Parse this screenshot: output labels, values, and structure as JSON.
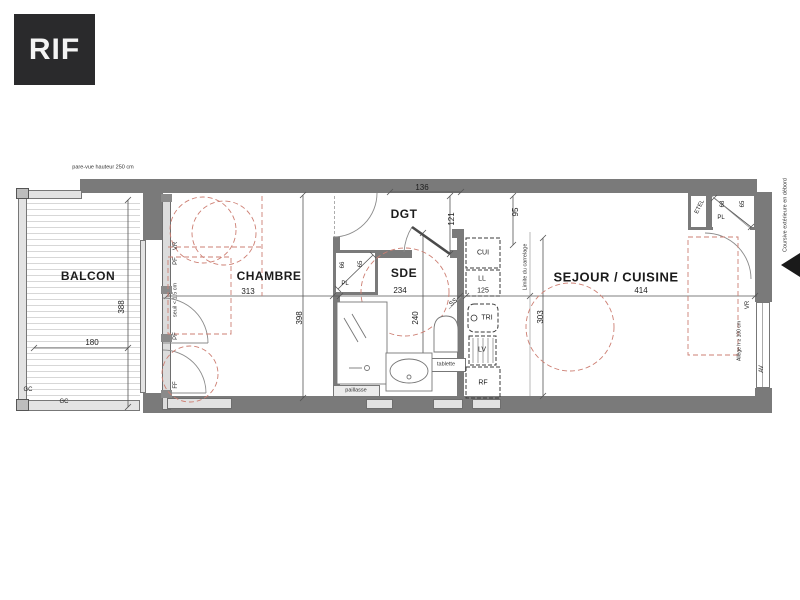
{
  "logo": {
    "text": "RIF"
  },
  "colors": {
    "wall": "#7a7a7a",
    "furniture_dashed": "#cd7f73",
    "logo_bg": "#2a2a2c"
  },
  "annotations": {
    "pare_vue": "pare-vue hauteur 250 cm",
    "coursive": "Coursive extérieure en débord",
    "limite_carrelage": "Limite du carrelage",
    "seuil": "seuil < 1.5 cm",
    "allege": "Allège h ≥ 100 cm"
  },
  "rooms": {
    "balcon": {
      "name": "BALCON",
      "width": "180",
      "height": "388"
    },
    "chambre": {
      "name": "CHAMBRE",
      "width": "313",
      "height": "398"
    },
    "sde": {
      "name": "SDE",
      "width": "234",
      "height": "240"
    },
    "dgt": {
      "name": "DGT",
      "width": "136",
      "height": "121"
    },
    "sejour": {
      "name": "SEJOUR / CUISINE",
      "width": "414",
      "height": "303"
    },
    "kitchen": {
      "width": "125",
      "depth": "95"
    }
  },
  "closets": {
    "chambre_pl": {
      "label": "PL",
      "dim_a": "66",
      "dim_b": "65"
    },
    "entry_pl": {
      "label": "PL",
      "dim_a": "68",
      "dim_b": "65",
      "etel": "ETEL"
    }
  },
  "fixtures": {
    "cui": "CUI",
    "ll": "LL",
    "tri": "TRI",
    "lv": "LV",
    "rf": "RF",
    "ss": "SS",
    "tablette": "tablette",
    "paillasse": "paillasse"
  },
  "openings": {
    "vr_left": "VR",
    "pf_left_1": "PF",
    "pf_left_2": "PF",
    "ff_left": "FF",
    "vr_right": "VR",
    "av_right": "AV",
    "gc_1": "GC",
    "gc_2": "GC"
  }
}
